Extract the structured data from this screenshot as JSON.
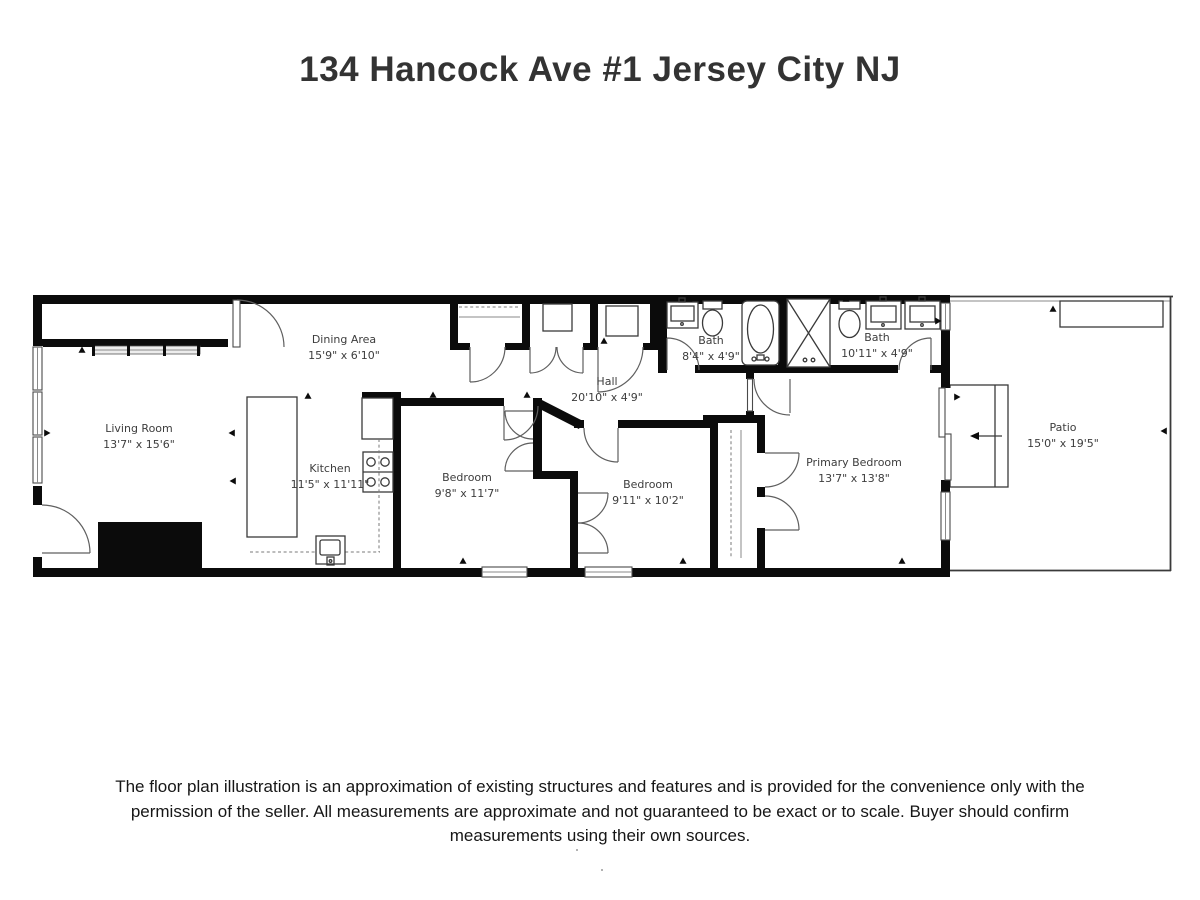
{
  "title": "134 Hancock Ave #1 Jersey City NJ",
  "colors": {
    "walls": "#000000",
    "room_text": "#3d3d3d",
    "title_text": "#333333"
  },
  "rooms": {
    "living_room": {
      "name": "Living Room",
      "dims": "13'7\" x 15'6\""
    },
    "dining_area": {
      "name": "Dining Area",
      "dims": "15'9\" x 6'10\""
    },
    "kitchen": {
      "name": "Kitchen",
      "dims": "11'5\" x 11'11\""
    },
    "hall": {
      "name": "Hall",
      "dims": "20'10\" x 4'9\""
    },
    "bedroom_1": {
      "name": "Bedroom",
      "dims": "9'8\" x 11'7\""
    },
    "bedroom_2": {
      "name": "Bedroom",
      "dims": "9'11\" x 10'2\""
    },
    "bath_1": {
      "name": "Bath",
      "dims": "8'4\" x 4'9\""
    },
    "bath_2": {
      "name": "Bath",
      "dims": "10'11\" x 4'9\""
    },
    "primary_bedroom": {
      "name": "Primary Bedroom",
      "dims": "13'7\" x 13'8\""
    },
    "patio": {
      "name": "Patio",
      "dims": "15'0\" x 19'5\""
    }
  },
  "disclaimer": [
    "The floor plan illustration is an approximation of existing structures and features and is provided for the convenience only with the",
    "permission of the seller. All measurements are approximate and not guaranteed to be exact or to scale. Buyer should confirm",
    "measurements using their own sources."
  ]
}
